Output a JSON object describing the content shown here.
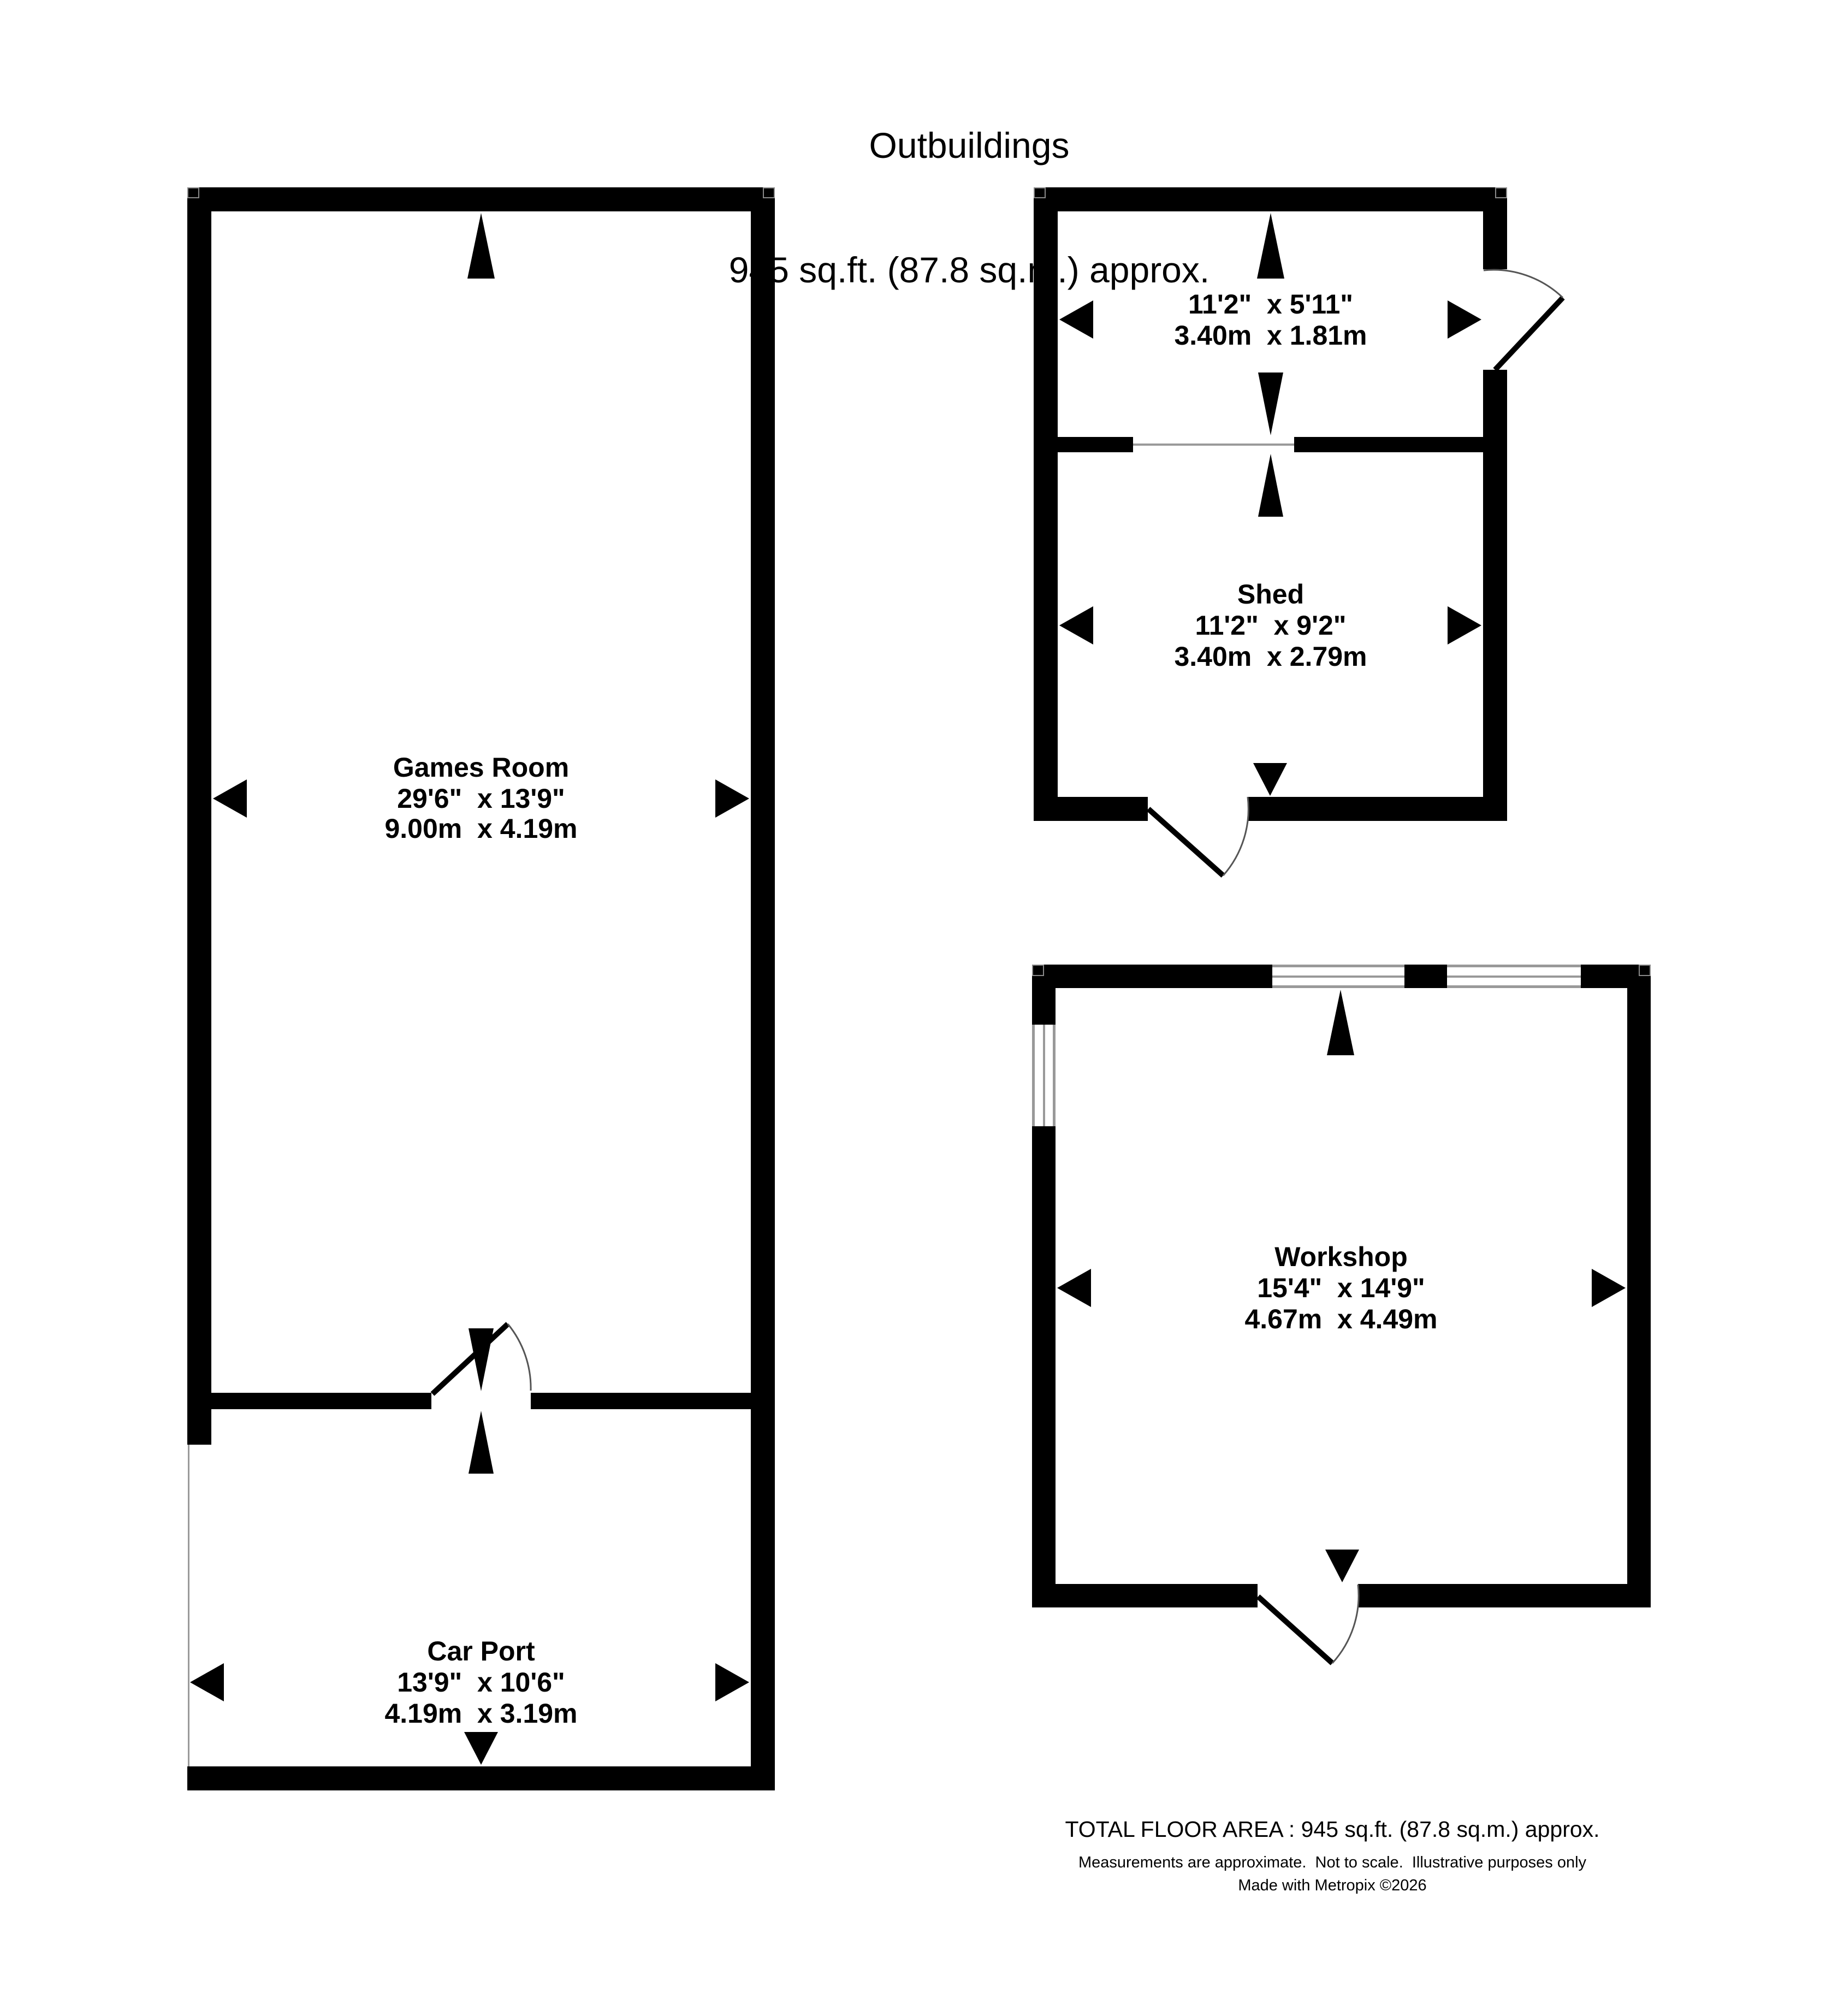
{
  "title": {
    "line1": "Outbuildings",
    "line2": "945 sq.ft. (87.8 sq.m.) approx."
  },
  "rooms": {
    "games": {
      "name": "Games Room",
      "dims_ft": "29'6\"  x 13'9\"",
      "dims_m": "9.00m  x 4.19m"
    },
    "carport": {
      "name": "Car Port",
      "dims_ft": "13'9\"  x 10'6\"",
      "dims_m": "4.19m  x 3.19m"
    },
    "store": {
      "dims_ft": "11'2\"  x 5'11\"",
      "dims_m": "3.40m  x 1.81m"
    },
    "shed": {
      "name": "Shed",
      "dims_ft": "11'2\"  x 9'2\"",
      "dims_m": "3.40m  x 2.79m"
    },
    "workshop": {
      "name": "Workshop",
      "dims_ft": "15'4\"  x 14'9\"",
      "dims_m": "4.67m  x 4.49m"
    }
  },
  "footer": {
    "total": "TOTAL FLOOR AREA : 945 sq.ft. (87.8 sq.m.) approx.",
    "disclaimer": "Measurements are approximate.  Not to scale.  Illustrative purposes only",
    "credit": "Made with Metropix ©2026"
  },
  "colors": {
    "wall": "#000000",
    "window_frame": "#999999",
    "door_arc": "#555555",
    "text": "#000000",
    "background": "#ffffff"
  }
}
